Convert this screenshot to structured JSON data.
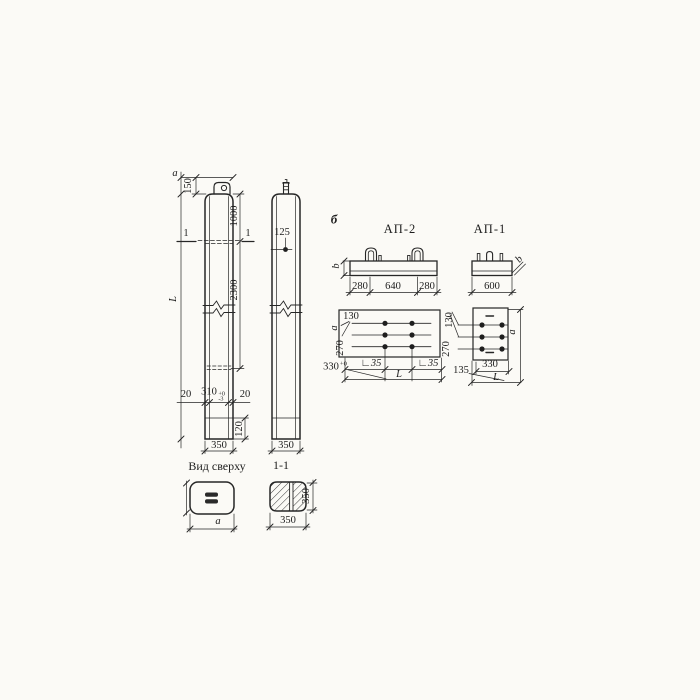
{
  "poles": {
    "left": {
      "width_label": "a",
      "dim_150": "150",
      "length_label": "L",
      "section_mark": "1",
      "dim_1000": "1000",
      "dim_2300": "2300",
      "wall_left": "20",
      "dim_310": "310",
      "tol_plus": "+0",
      "tol_minus": "-3",
      "wall_right": "20",
      "dim_120": "120",
      "dim_350": "350"
    },
    "right": {
      "dim_125": "125",
      "dim_350": "350"
    }
  },
  "top_view": {
    "title": "Вид сверху",
    "width_label": "a"
  },
  "section_view": {
    "title": "1-1",
    "dim_side": "350",
    "dim_bottom": "350"
  },
  "detail_marker": "б",
  "ap2": {
    "title": "АП-2",
    "height_label": "b",
    "dim_280_left": "280",
    "dim_640": "640",
    "dim_280_right": "280",
    "plan": {
      "dim_130": "130",
      "width_label": "a",
      "dim_270": "270",
      "dim_330": "330",
      "tol_plus": "+0",
      "angle_left": "∟35",
      "angle_right": "∟35",
      "length_label": "L"
    }
  },
  "ap1": {
    "title": "АП-1",
    "dim_600": "600",
    "height_label": "b",
    "plan": {
      "dim_130": "130",
      "dim_270": "270",
      "dim_135": "135",
      "dim_330": "330",
      "length_label": "L",
      "width_label": "a"
    }
  }
}
